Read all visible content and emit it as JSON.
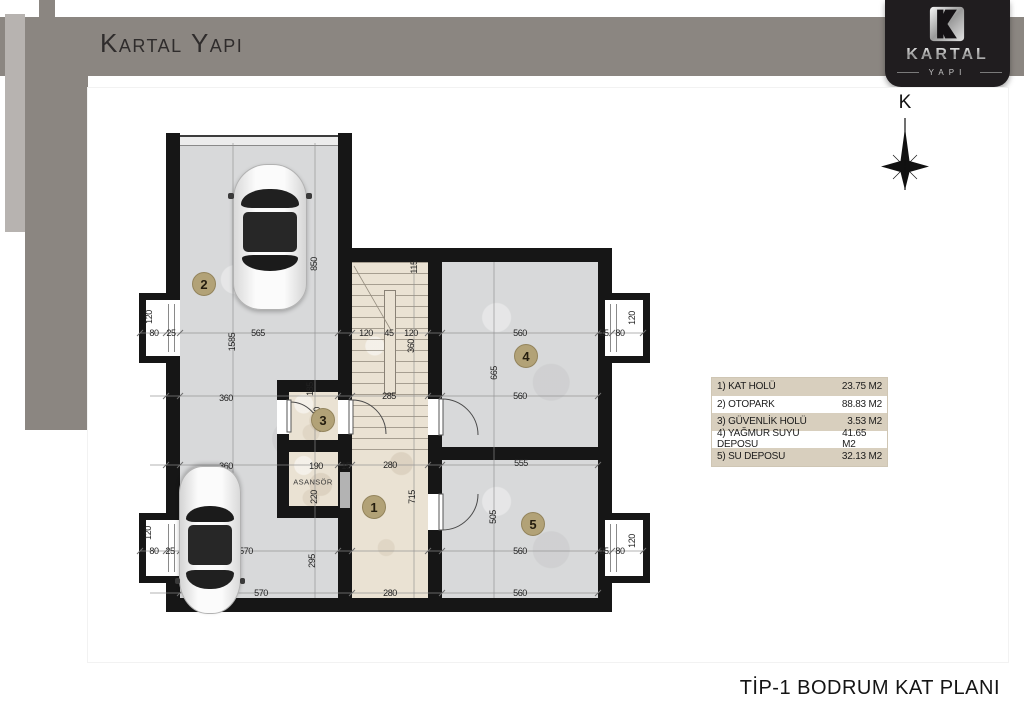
{
  "header": {
    "brand": "Kartal Yapı"
  },
  "logo": {
    "name": "KARTAL",
    "sub": "YAPI"
  },
  "north": {
    "label": "K"
  },
  "footer": {
    "title": "TİP-1 BODRUM KAT PLANI"
  },
  "legend": {
    "rows": [
      {
        "label": "1) KAT HOLÜ",
        "area": "23.75 M2"
      },
      {
        "label": "2) OTOPARK",
        "area": "88.83 M2"
      },
      {
        "label": "3) GÜVENLİK HOLÜ",
        "area": "3.53 M2"
      },
      {
        "label": "4) YAĞMUR SUYU DEPOSU",
        "area": "41.65 M2"
      },
      {
        "label": "5) SU DEPOSU",
        "area": "32.13 M2"
      }
    ]
  },
  "plan": {
    "elevator_label": "ASANSÖR",
    "rooms": [
      {
        "n": "1",
        "x": 374,
        "y": 507
      },
      {
        "n": "2",
        "x": 204,
        "y": 284
      },
      {
        "n": "3",
        "x": 323,
        "y": 420
      },
      {
        "n": "4",
        "x": 526,
        "y": 356
      },
      {
        "n": "5",
        "x": 533,
        "y": 524
      }
    ],
    "dim_labels": [
      {
        "t": "80",
        "x": 154,
        "y": 333
      },
      {
        "t": "25",
        "x": 171,
        "y": 333
      },
      {
        "t": "565",
        "x": 258,
        "y": 333
      },
      {
        "t": "120",
        "x": 366,
        "y": 333
      },
      {
        "t": "45",
        "x": 389,
        "y": 333
      },
      {
        "t": "120",
        "x": 411,
        "y": 333
      },
      {
        "t": "560",
        "x": 520,
        "y": 333
      },
      {
        "t": "25",
        "x": 604,
        "y": 333
      },
      {
        "t": "80",
        "x": 620,
        "y": 333
      },
      {
        "t": "120",
        "x": 149,
        "y": 317,
        "v": true
      },
      {
        "t": "1585",
        "x": 232,
        "y": 342,
        "v": true
      },
      {
        "t": "850",
        "x": 314,
        "y": 264,
        "v": true
      },
      {
        "t": "115",
        "x": 414,
        "y": 267,
        "v": true
      },
      {
        "t": "360",
        "x": 411,
        "y": 346,
        "v": true
      },
      {
        "t": "120",
        "x": 632,
        "y": 318,
        "v": true
      },
      {
        "t": "360",
        "x": 226,
        "y": 398
      },
      {
        "t": "285",
        "x": 389,
        "y": 396
      },
      {
        "t": "560",
        "x": 520,
        "y": 396
      },
      {
        "t": "185",
        "x": 310,
        "y": 389,
        "v": true
      },
      {
        "t": "150",
        "x": 317,
        "y": 414,
        "v": true
      },
      {
        "t": "665",
        "x": 494,
        "y": 373,
        "v": true
      },
      {
        "t": "360",
        "x": 226,
        "y": 466
      },
      {
        "t": "190",
        "x": 316,
        "y": 466
      },
      {
        "t": "15",
        "x": 346,
        "y": 466
      },
      {
        "t": "280",
        "x": 390,
        "y": 465
      },
      {
        "t": "555",
        "x": 521,
        "y": 463
      },
      {
        "t": "220",
        "x": 314,
        "y": 497,
        "v": true
      },
      {
        "t": "715",
        "x": 412,
        "y": 497,
        "v": true
      },
      {
        "t": "505",
        "x": 493,
        "y": 517,
        "v": true
      },
      {
        "t": "295",
        "x": 312,
        "y": 561,
        "v": true
      },
      {
        "t": "80",
        "x": 154,
        "y": 551
      },
      {
        "t": "25",
        "x": 170,
        "y": 551
      },
      {
        "t": "570",
        "x": 246,
        "y": 551
      },
      {
        "t": "560",
        "x": 520,
        "y": 551
      },
      {
        "t": "25",
        "x": 604,
        "y": 551
      },
      {
        "t": "80",
        "x": 620,
        "y": 551
      },
      {
        "t": "120",
        "x": 148,
        "y": 533,
        "v": true
      },
      {
        "t": "120",
        "x": 632,
        "y": 541,
        "v": true
      },
      {
        "t": "570",
        "x": 261,
        "y": 593
      },
      {
        "t": "280",
        "x": 390,
        "y": 593
      },
      {
        "t": "560",
        "x": 520,
        "y": 593
      }
    ]
  },
  "colors": {
    "header_band": "#8b8681",
    "logo_bg": "#201d1f",
    "wall": "#161616",
    "concrete_floor": "#d8d9da",
    "marble_floor": "#eae2d3",
    "room_badge": "#b2a277",
    "legend_tan": "#d8cfbe"
  }
}
